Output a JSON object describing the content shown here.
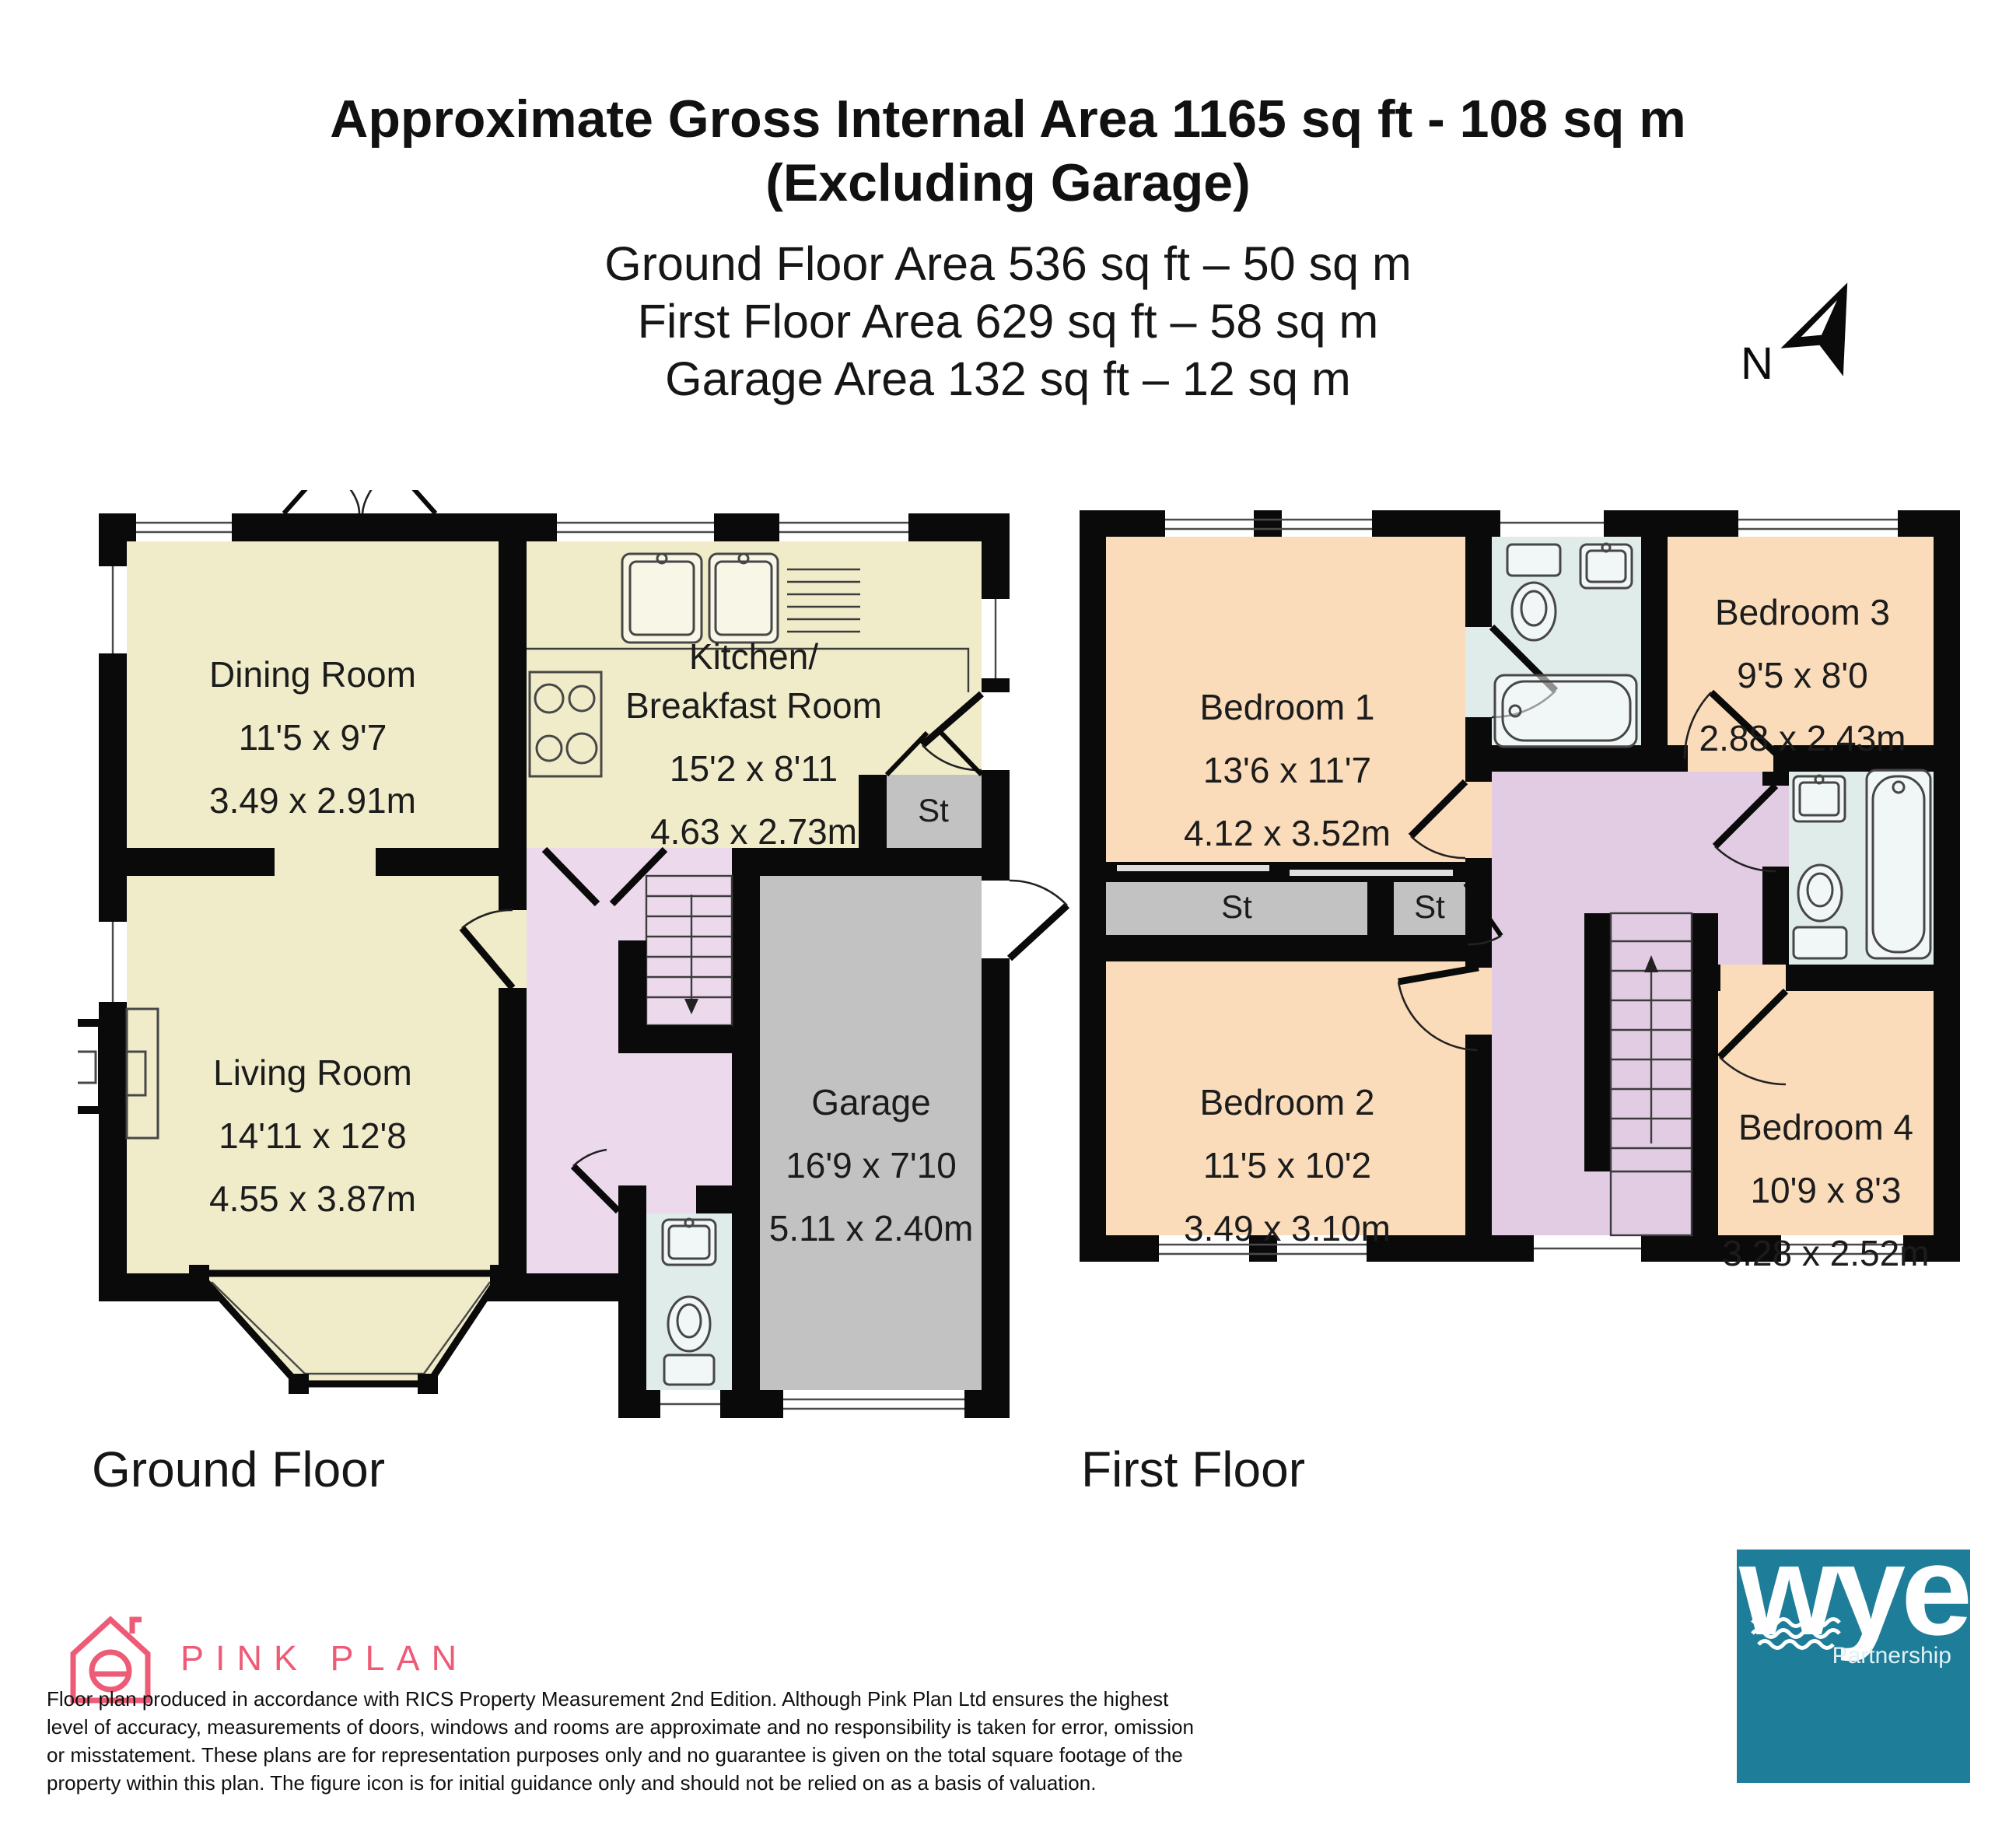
{
  "header": {
    "title_line1": "Approximate Gross Internal Area 1165 sq ft - 108 sq m",
    "title_line2": "(Excluding Garage)",
    "area_lines": [
      "Ground Floor Area 536 sq ft – 50 sq m",
      "First Floor Area 629 sq ft – 58 sq m",
      "Garage Area 132 sq ft – 12 sq m"
    ]
  },
  "compass": {
    "north_label": "N"
  },
  "floors": {
    "ground": {
      "label": "Ground Floor",
      "rooms": {
        "dining": {
          "name": "Dining Room",
          "imperial": "11'5 x 9'7",
          "metric": "3.49 x 2.91m"
        },
        "kitchen": {
          "name": "Kitchen/\nBreakfast Room",
          "imperial": "15'2 x 8'11",
          "metric": "4.63 x 2.73m"
        },
        "living": {
          "name": "Living Room",
          "imperial": "14'11 x 12'8",
          "metric": "4.55 x 3.87m"
        },
        "garage": {
          "name": "Garage",
          "imperial": "16'9 x 7'10",
          "metric": "5.11 x 2.40m"
        },
        "store": {
          "name": "St"
        }
      }
    },
    "first": {
      "label": "First Floor",
      "rooms": {
        "bedroom1": {
          "name": "Bedroom 1",
          "imperial": "13'6 x 11'7",
          "metric": "4.12 x 3.52m"
        },
        "bedroom2": {
          "name": "Bedroom 2",
          "imperial": "11'5 x 10'2",
          "metric": "3.49 x 3.10m"
        },
        "bedroom3": {
          "name": "Bedroom 3",
          "imperial": "9'5 x 8'0",
          "metric": "2.88 x 2.43m"
        },
        "bedroom4": {
          "name": "Bedroom 4",
          "imperial": "10'9 x 8'3",
          "metric": "3.28 x 2.52m"
        },
        "store_long": {
          "name": "St"
        },
        "store_small": {
          "name": "St"
        }
      }
    }
  },
  "footer": {
    "producer_brand": "PINK PLAN",
    "disclaimer": "Floor plan produced in accordance with RICS Property Measurement 2nd Edition. Although Pink Plan Ltd ensures the highest\nlevel of accuracy, measurements of doors, windows and rooms are approximate and no responsibility is taken for error, omission\nor misstatement. These plans are for representation purposes only and no guarantee is given on the total square footage of the\nproperty within this plan. The figure icon is for initial guidance only and should not be relied on as a basis of valuation.",
    "agent_brand": "wye",
    "agent_sub": "Partnership"
  },
  "colors": {
    "wall": "#0a0a0a",
    "room_cream": "#f0ecca",
    "room_peach": "#fadcba",
    "hall_lilac": "#ecd9ec",
    "landing_lilac": "#e2cce3",
    "garage_gray": "#c3c2c2",
    "bath_blue": "#dfecea",
    "brand_pink": "#ee5b76",
    "brand_teal": "#1e7e9a"
  }
}
